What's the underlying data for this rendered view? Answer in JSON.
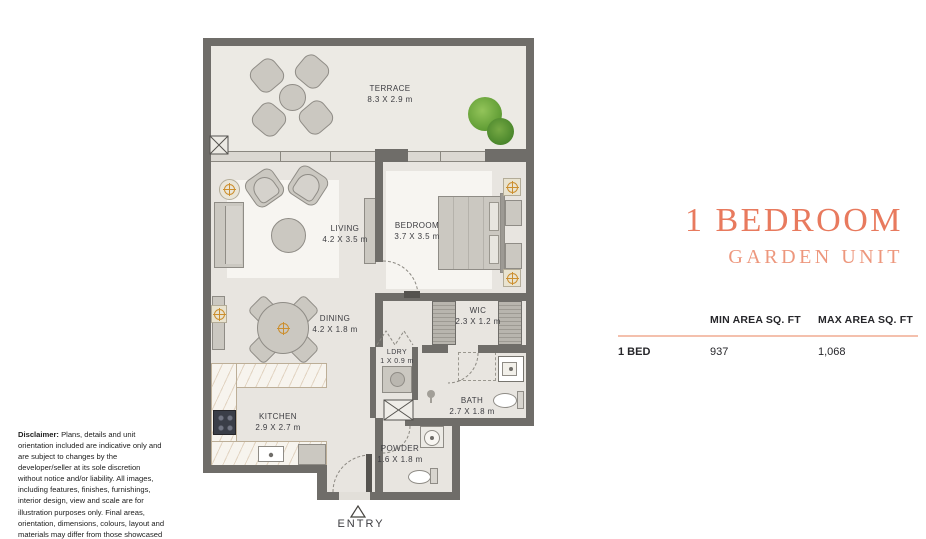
{
  "title": {
    "main": "1 BEDROOM",
    "sub": "GARDEN UNIT"
  },
  "area_table": {
    "min_header": "MIN AREA SQ. FT",
    "max_header": "MAX AREA SQ. FT",
    "row_label": "1 BED",
    "min_value": "937",
    "max_value": "1,068"
  },
  "rooms": {
    "terrace": {
      "name": "TERRACE",
      "dims": "8.3 X 2.9 m"
    },
    "living": {
      "name": "LIVING",
      "dims": "4.2 X 3.5 m"
    },
    "bedroom": {
      "name": "BEDROOM",
      "dims": "3.7 X 3.5 m"
    },
    "dining": {
      "name": "DINING",
      "dims": "4.2 X 1.8 m"
    },
    "wic": {
      "name": "WIC",
      "dims": "2.3 X 1.2 m"
    },
    "ldry": {
      "name": "LDRY",
      "dims": "1 X 0.9 m"
    },
    "kitchen": {
      "name": "KITCHEN",
      "dims": "2.9 X 2.7 m"
    },
    "bath": {
      "name": "BATH",
      "dims": "2.7 X 1.8 m"
    },
    "powder": {
      "name": "POWDER",
      "dims": "1.6 X 1.8 m"
    }
  },
  "entry": {
    "label": "ENTRY"
  },
  "disclaimer": {
    "label": "Disclaimer:",
    "text": " Plans, details and unit orientation included are indicative only and are subject to changes by the developer/seller at its sole discretion without notice and/or liability. All images, including features, finishes, furnishings, interior design, view and scale are for illustration purposes only. Final areas, orientation, dimensions, colours, layout and materials may differ from those showcased in this brochure or the show apartment."
  },
  "colors": {
    "accent": "#E87A5E",
    "accent2": "#ED977D",
    "divider": "#F4C0AD",
    "wall": "#6F6D69",
    "floor": "#E8E5E0",
    "floor2": "#ECEAE4",
    "rug": "#F7F5F1",
    "furn": "#CBC8C1",
    "marble": "#F7F4EE",
    "glass": "#DBD8D2",
    "orange": "#CC8F2E",
    "plantext": "#3C3C40",
    "textdark": "#26262A"
  }
}
